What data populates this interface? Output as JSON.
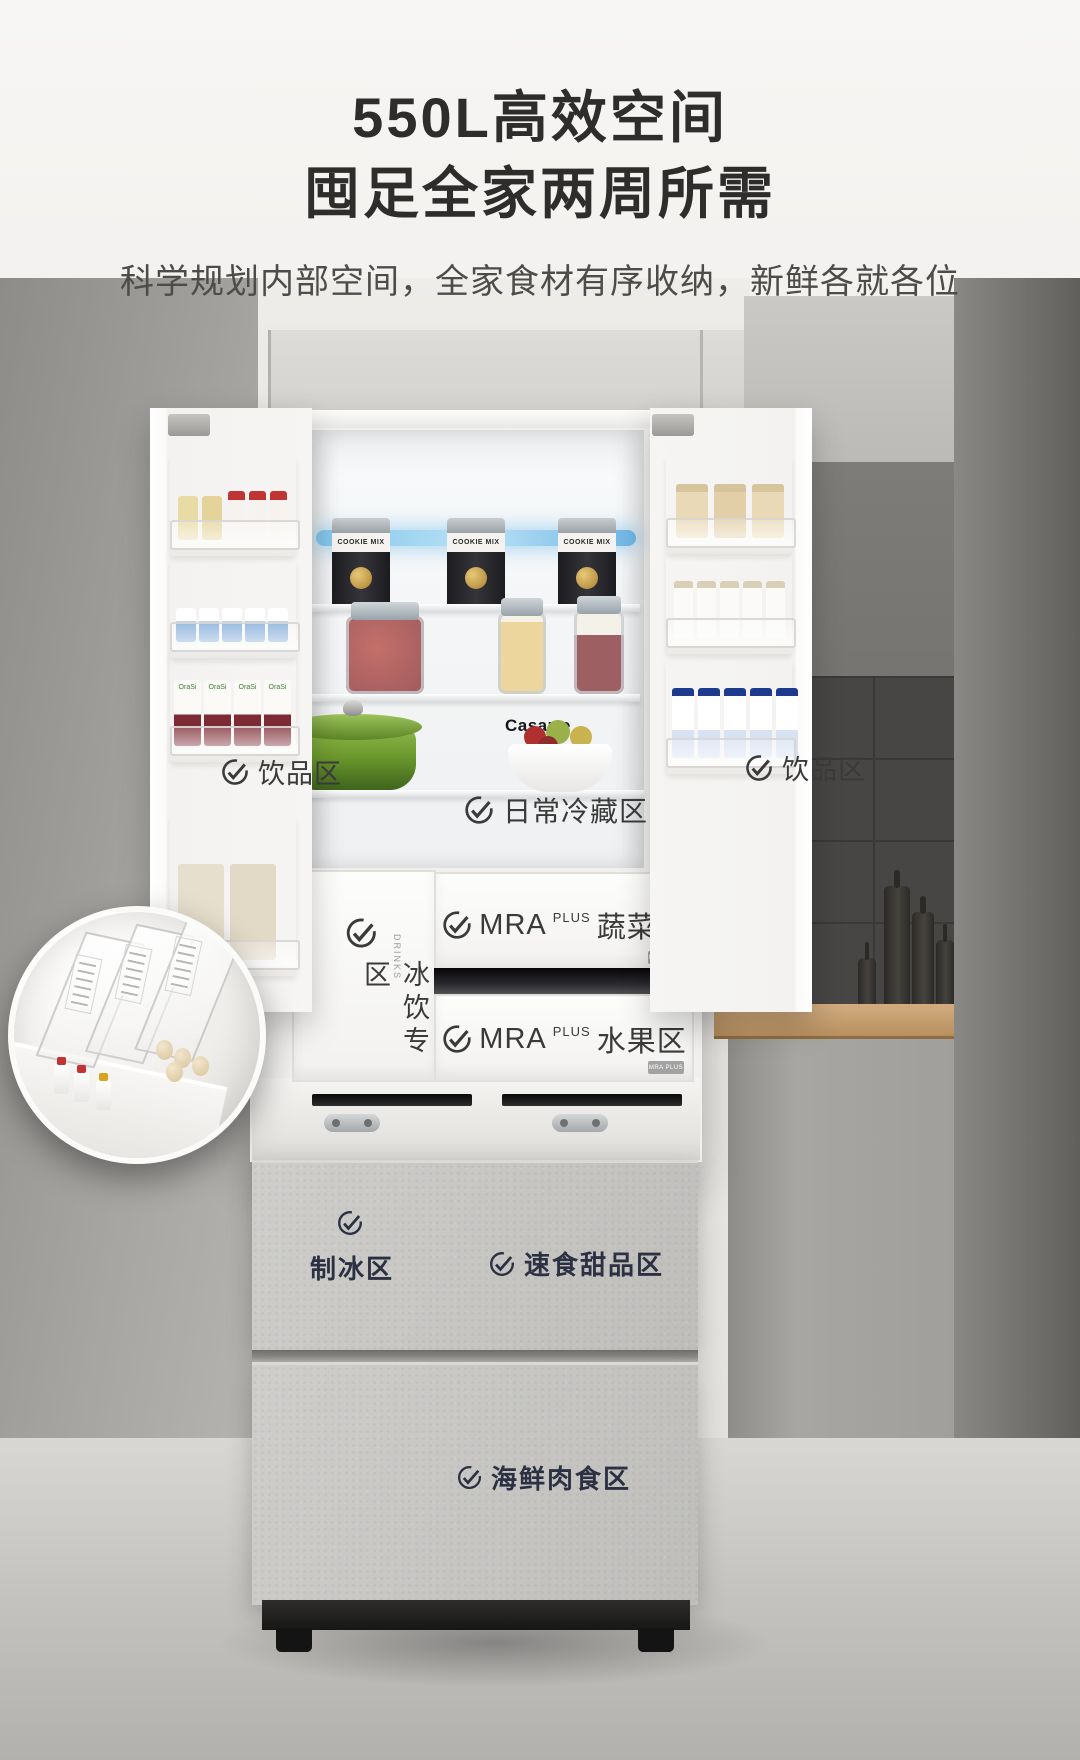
{
  "hero": {
    "title_line1": "550L高效空间",
    "title_line2": "囤足全家两周所需",
    "subtitle": "科学规划内部空间，全家食材有序收纳，新鲜各就各位"
  },
  "brand": {
    "name": "Casarte"
  },
  "zones": {
    "left_door": "饮品区",
    "right_door": "饮品区",
    "cold": "日常冷藏区",
    "ice_drink": "冰饮专区",
    "ice_drink_side": "DRINKS",
    "veg": {
      "prefix": "MRA",
      "sup": "PLUS",
      "name": "蔬菜区"
    },
    "fruit": {
      "prefix": "MRA",
      "sup": "PLUS",
      "name": "水果区"
    },
    "badge": "MRA PLUS",
    "ice": "制冰区",
    "dessert": "速食甜品区",
    "seafood": "海鲜肉食区"
  },
  "items": {
    "can_label": "COOKIE MIX",
    "carton_brand": "OraSi"
  }
}
